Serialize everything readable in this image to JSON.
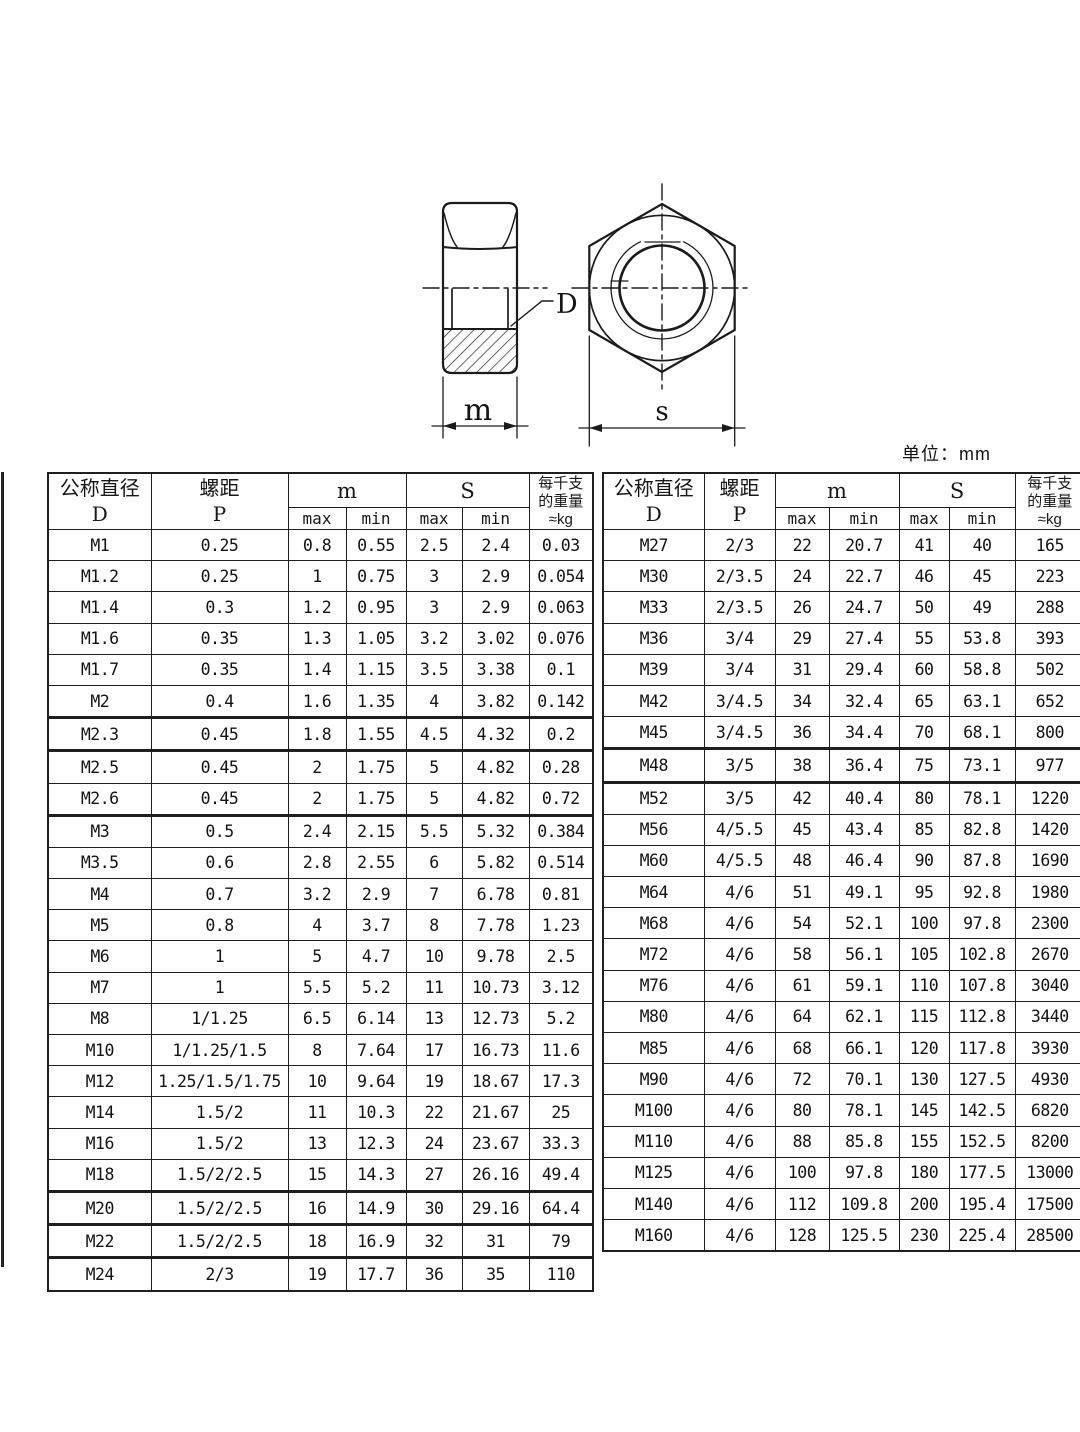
{
  "page": {
    "unit_label": "单位：mm"
  },
  "drawing": {
    "labels": {
      "bore": "D",
      "height": "m",
      "width_across_flats": "s"
    }
  },
  "table_header": {
    "col_diameter_title": "公称直径",
    "col_diameter_symbol": "D",
    "col_pitch_title": "螺距",
    "col_pitch_symbol": "P",
    "col_m": "m",
    "col_s": "S",
    "sub_max": "max",
    "sub_min": "min",
    "col_weight_line1": "每千支",
    "col_weight_line2": "的重量",
    "col_weight_line3": "≈kg"
  },
  "left_table": {
    "rows": [
      [
        "M1",
        "0.25",
        "0.8",
        "0.55",
        "2.5",
        "2.4",
        "0.03"
      ],
      [
        "M1.2",
        "0.25",
        "1",
        "0.75",
        "3",
        "2.9",
        "0.054"
      ],
      [
        "M1.4",
        "0.3",
        "1.2",
        "0.95",
        "3",
        "2.9",
        "0.063"
      ],
      [
        "M1.6",
        "0.35",
        "1.3",
        "1.05",
        "3.2",
        "3.02",
        "0.076"
      ],
      [
        "M1.7",
        "0.35",
        "1.4",
        "1.15",
        "3.5",
        "3.38",
        "0.1"
      ],
      [
        "M2",
        "0.4",
        "1.6",
        "1.35",
        "4",
        "3.82",
        "0.142"
      ],
      [
        "M2.3",
        "0.45",
        "1.8",
        "1.55",
        "4.5",
        "4.32",
        "0.2"
      ],
      [
        "M2.5",
        "0.45",
        "2",
        "1.75",
        "5",
        "4.82",
        "0.28"
      ],
      [
        "M2.6",
        "0.45",
        "2",
        "1.75",
        "5",
        "4.82",
        "0.72"
      ],
      [
        "M3",
        "0.5",
        "2.4",
        "2.15",
        "5.5",
        "5.32",
        "0.384"
      ],
      [
        "M3.5",
        "0.6",
        "2.8",
        "2.55",
        "6",
        "5.82",
        "0.514"
      ],
      [
        "M4",
        "0.7",
        "3.2",
        "2.9",
        "7",
        "6.78",
        "0.81"
      ],
      [
        "M5",
        "0.8",
        "4",
        "3.7",
        "8",
        "7.78",
        "1.23"
      ],
      [
        "M6",
        "1",
        "5",
        "4.7",
        "10",
        "9.78",
        "2.5"
      ],
      [
        "M7",
        "1",
        "5.5",
        "5.2",
        "11",
        "10.73",
        "3.12"
      ],
      [
        "M8",
        "1/1.25",
        "6.5",
        "6.14",
        "13",
        "12.73",
        "5.2"
      ],
      [
        "M10",
        "1/1.25/1.5",
        "8",
        "7.64",
        "17",
        "16.73",
        "11.6"
      ],
      [
        "M12",
        "1.25/1.5/1.75",
        "10",
        "9.64",
        "19",
        "18.67",
        "17.3"
      ],
      [
        "M14",
        "1.5/2",
        "11",
        "10.3",
        "22",
        "21.67",
        "25"
      ],
      [
        "M16",
        "1.5/2",
        "13",
        "12.3",
        "24",
        "23.67",
        "33.3"
      ],
      [
        "M18",
        "1.5/2/2.5",
        "15",
        "14.3",
        "27",
        "26.16",
        "49.4"
      ],
      [
        "M20",
        "1.5/2/2.5",
        "16",
        "14.9",
        "30",
        "29.16",
        "64.4"
      ],
      [
        "M22",
        "1.5/2/2.5",
        "18",
        "16.9",
        "32",
        "31",
        "79"
      ],
      [
        "M24",
        "2/3",
        "19",
        "17.7",
        "36",
        "35",
        "110"
      ]
    ]
  },
  "right_table": {
    "rows": [
      [
        "M27",
        "2/3",
        "22",
        "20.7",
        "41",
        "40",
        "165"
      ],
      [
        "M30",
        "2/3.5",
        "24",
        "22.7",
        "46",
        "45",
        "223"
      ],
      [
        "M33",
        "2/3.5",
        "26",
        "24.7",
        "50",
        "49",
        "288"
      ],
      [
        "M36",
        "3/4",
        "29",
        "27.4",
        "55",
        "53.8",
        "393"
      ],
      [
        "M39",
        "3/4",
        "31",
        "29.4",
        "60",
        "58.8",
        "502"
      ],
      [
        "M42",
        "3/4.5",
        "34",
        "32.4",
        "65",
        "63.1",
        "652"
      ],
      [
        "M45",
        "3/4.5",
        "36",
        "34.4",
        "70",
        "68.1",
        "800"
      ],
      [
        "M48",
        "3/5",
        "38",
        "36.4",
        "75",
        "73.1",
        "977"
      ],
      [
        "M52",
        "3/5",
        "42",
        "40.4",
        "80",
        "78.1",
        "1220"
      ],
      [
        "M56",
        "4/5.5",
        "45",
        "43.4",
        "85",
        "82.8",
        "1420"
      ],
      [
        "M60",
        "4/5.5",
        "48",
        "46.4",
        "90",
        "87.8",
        "1690"
      ],
      [
        "M64",
        "4/6",
        "51",
        "49.1",
        "95",
        "92.8",
        "1980"
      ],
      [
        "M68",
        "4/6",
        "54",
        "52.1",
        "100",
        "97.8",
        "2300"
      ],
      [
        "M72",
        "4/6",
        "58",
        "56.1",
        "105",
        "102.8",
        "2670"
      ],
      [
        "M76",
        "4/6",
        "61",
        "59.1",
        "110",
        "107.8",
        "3040"
      ],
      [
        "M80",
        "4/6",
        "64",
        "62.1",
        "115",
        "112.8",
        "3440"
      ],
      [
        "M85",
        "4/6",
        "68",
        "66.1",
        "120",
        "117.8",
        "3930"
      ],
      [
        "M90",
        "4/6",
        "72",
        "70.1",
        "130",
        "127.5",
        "4930"
      ],
      [
        "M100",
        "4/6",
        "80",
        "78.1",
        "145",
        "142.5",
        "6820"
      ],
      [
        "M110",
        "4/6",
        "88",
        "85.8",
        "155",
        "152.5",
        "8200"
      ],
      [
        "M125",
        "4/6",
        "100",
        "97.8",
        "180",
        "177.5",
        "13000"
      ],
      [
        "M140",
        "4/6",
        "112",
        "109.8",
        "200",
        "195.4",
        "17500"
      ],
      [
        "M160",
        "4/6",
        "128",
        "125.5",
        "230",
        "225.4",
        "28500"
      ]
    ]
  }
}
